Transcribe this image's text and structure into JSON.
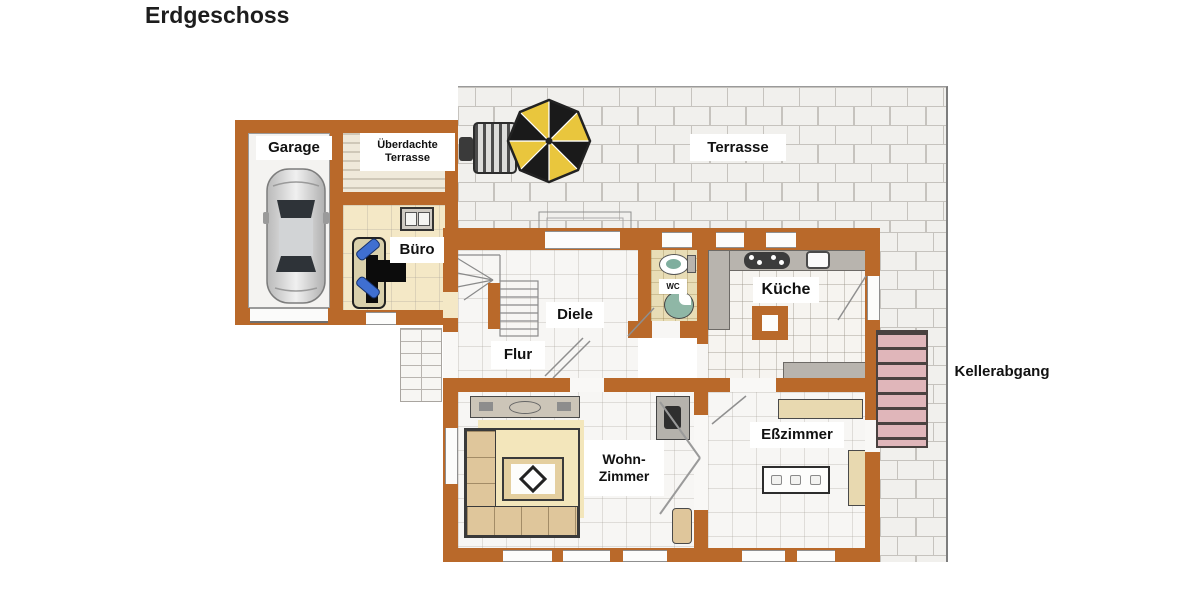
{
  "title": "Erdgeschoss",
  "floor_plan": {
    "rooms": {
      "garage": {
        "label": "Garage"
      },
      "covered_terrace": {
        "label_line1": "Überdachte",
        "label_line2": "Terrasse"
      },
      "office": {
        "label": "Büro"
      },
      "terrace": {
        "label": "Terrasse"
      },
      "hallway": {
        "label": "Diele"
      },
      "wc": {
        "label": "WC"
      },
      "kitchen": {
        "label": "Küche"
      },
      "corridor": {
        "label": "Flur"
      },
      "basement_stairs": {
        "label": "Kellerabgang"
      },
      "living_room": {
        "label_line1": "Wohn-",
        "label_line2": "Zimmer"
      },
      "dining_room": {
        "label": "Eßzimmer"
      }
    },
    "colors": {
      "wall": "#b9692a",
      "terrace_tile_fill": "#f1f0ed",
      "terrace_tile_line": "#c6c3be",
      "basement_step_pink": "#e0b6ba",
      "office_floor": "#f4e8c6",
      "wc_floor": "#e8ddb6",
      "umbrella_yellow": "#e9c63d",
      "umbrella_black": "#1a1a1a",
      "office_chair_blue": "#3f6fd1",
      "dining_chair_mauve": "#c9999b",
      "sofa_tan": "#dfc69b",
      "rug_yellow": "#f3e6bb",
      "car_silver": "#d9d9d9"
    },
    "icons": [
      "car-icon",
      "umbrella-icon",
      "grill-icon",
      "desk-icon",
      "office-chair-icon",
      "printer-icon",
      "stair-icon",
      "toilet-icon",
      "sink-icon",
      "stove-icon",
      "kitchen-sink-icon",
      "kitchen-island-icon",
      "sofa-icon",
      "coffee-table-icon",
      "rug-icon",
      "sideboard-icon",
      "tv-icon",
      "dining-table-icon",
      "dining-chair-icon",
      "cabinet-icon",
      "basement-stair-icon",
      "entrance-steps-icon"
    ]
  }
}
